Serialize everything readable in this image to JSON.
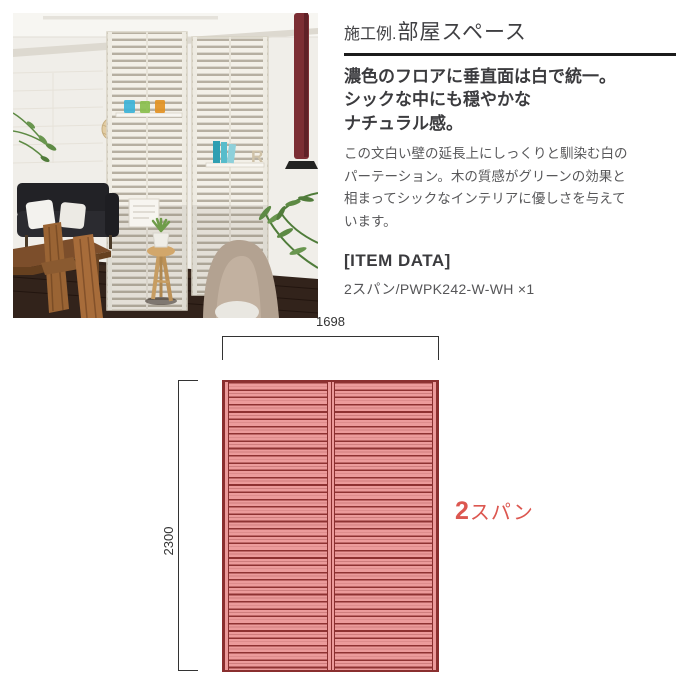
{
  "photo": {
    "shelf_letter": "R"
  },
  "article": {
    "title_prefix": "施工例.",
    "title_main": "部屋スペース",
    "headline_lines": [
      "濃色のフロアに垂直面は白で統一。",
      "シックな中にも穏やかな",
      "ナチュラル感。"
    ],
    "body_lines": [
      "この文白い壁の延長上にしっくりと馴染む白の",
      "パーテーション。木の質感がグリーンの効果と",
      "相まってシックなインテリアに優しさを与えて",
      "います。"
    ],
    "item_data_heading": "[ITEM DATA]",
    "item_line": "2スパン/PWPK242-W-WH ×1"
  },
  "diagram": {
    "width_label": "1698",
    "height_label": "2300",
    "span_label": "2スパン",
    "colors": {
      "slat_pink": "#ec9b9b",
      "slat_dark": "#8e3232",
      "frame_red": "#8a2f2f",
      "span_label_red": "#dc5750",
      "dimension_line": "#333333"
    }
  }
}
